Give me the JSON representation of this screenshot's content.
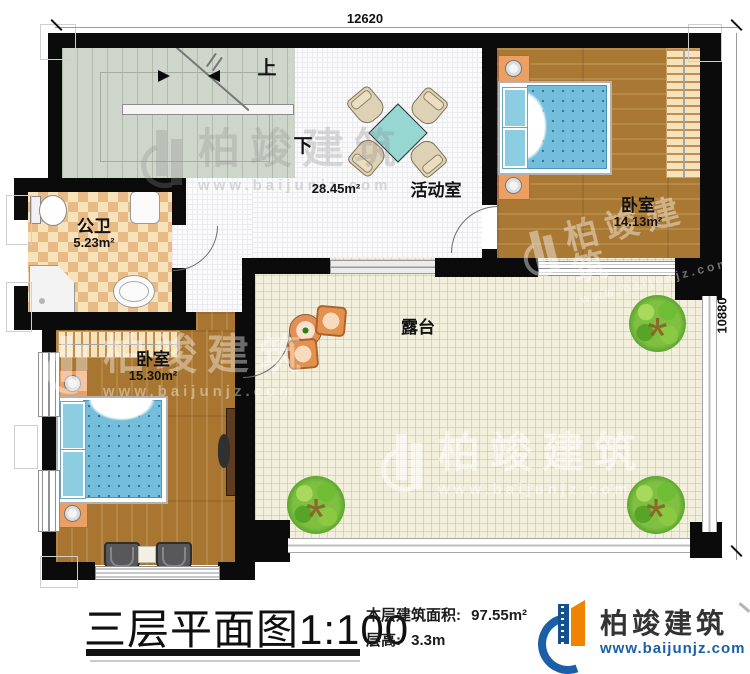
{
  "plan": {
    "dim_top": "12620",
    "dim_right": "10880",
    "stairs": {
      "up": "上",
      "down": "下"
    },
    "activity": {
      "name": "活动室",
      "area": "28.45m²"
    },
    "bathroom": {
      "name": "公卫",
      "area": "5.23m²"
    },
    "bedroom_top": {
      "name": "卧室",
      "area": "14.13m²"
    },
    "bedroom_bottom": {
      "name": "卧室",
      "area": "15.30m²"
    },
    "terrace": {
      "name": "露台"
    }
  },
  "footer": {
    "title": "三层平面图",
    "scale": "1:100",
    "area_label": "本层建筑面积:",
    "area_value": "97.55m²",
    "height_label": "层高:",
    "height_value": "3.3m"
  },
  "brand": {
    "name": "柏竣建筑",
    "site": "www.baijunjz.com",
    "blue": "#1a5fa8",
    "orange": "#f08300"
  },
  "watermark": {
    "name": "柏竣建筑",
    "site": "www.baijunjz.com"
  }
}
